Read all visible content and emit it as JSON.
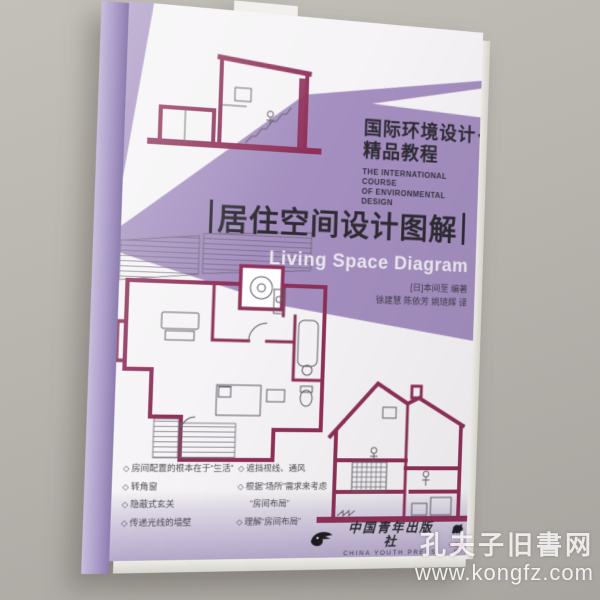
{
  "watermark": {
    "site_name": "孔夫子旧書网",
    "site_url": "www.kongfz.com"
  },
  "cover": {
    "series": {
      "zh_line1": "国际环境设计",
      "zh_line2": "精品教程",
      "en_line1": "THE INTERNATIONAL COURSE",
      "en_line2": "OF ENVIRONMENTAL DESIGN"
    },
    "title": {
      "bar": "|",
      "zh": "居住空间设计图解",
      "en": "Living Space Diagram"
    },
    "credits": {
      "author": "[日]本间至 编著",
      "translators": "徐建慧 陈依芳 姚琏辉 译"
    },
    "bullets_left": [
      {
        "bullet": "◇",
        "text": "房间配置的根本在于“生活”"
      },
      {
        "bullet": "◇",
        "text": "转角窗"
      },
      {
        "bullet": "◇",
        "text": "隐蔽式玄关"
      },
      {
        "bullet": "◇",
        "text": "传递光线的墙壁"
      }
    ],
    "bullets_right": [
      {
        "bullet": "◇",
        "text": "遮挡视线、通风"
      },
      {
        "bullet": "◇",
        "text": "根据“场所”需求来考虑"
      },
      {
        "bullet": "",
        "text": "“房间布局”"
      },
      {
        "bullet": "◇",
        "text": "理解“房间布局”"
      }
    ],
    "publisher": {
      "zh": "中国青年出版社",
      "en": "CHINA YOUTH PRESS",
      "imprint": "中青雄狮"
    }
  },
  "colors": {
    "background": "#b6b2ac",
    "purple": "#a48fc0",
    "magenta": "#8e3058",
    "ink": "#2e2b33",
    "band": "#b6a9cb",
    "white": "#f6f4f6"
  }
}
